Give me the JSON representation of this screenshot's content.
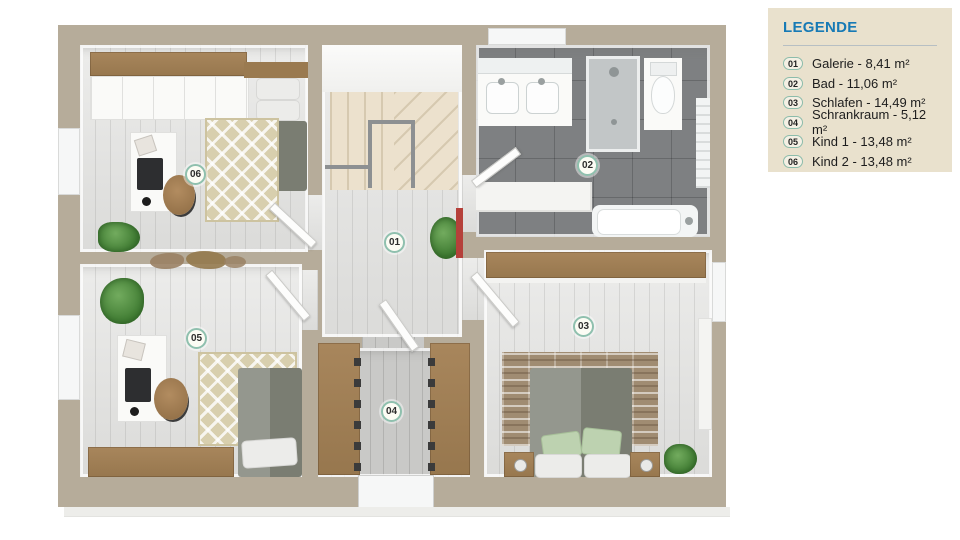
{
  "legend": {
    "title": "LEGENDE",
    "items": [
      {
        "num": "01",
        "text": "Galerie - 8,41 m²"
      },
      {
        "num": "02",
        "text": "Bad - 11,06 m²"
      },
      {
        "num": "03",
        "text": "Schlafen - 14,49 m²"
      },
      {
        "num": "04",
        "text": "Schrankraum - 5,12 m²"
      },
      {
        "num": "05",
        "text": "Kind 1 - 13,48 m²"
      },
      {
        "num": "06",
        "text": "Kind 2 - 13,48 m²"
      }
    ]
  },
  "rooms": [
    {
      "num": "01",
      "name": "Galerie"
    },
    {
      "num": "02",
      "name": "Bad"
    },
    {
      "num": "03",
      "name": "Schlafen"
    },
    {
      "num": "04",
      "name": "Schrankraum"
    },
    {
      "num": "05",
      "name": "Kind 1"
    },
    {
      "num": "06",
      "name": "Kind 2"
    }
  ],
  "colors": {
    "legend_background": "#e9e1cd",
    "legend_title": "#177ab5",
    "badge_ring": "#8cbcab",
    "wall": "#b6ac9a",
    "bath_tile": "#7e8082",
    "wood_floor": "#e4e4e2"
  }
}
